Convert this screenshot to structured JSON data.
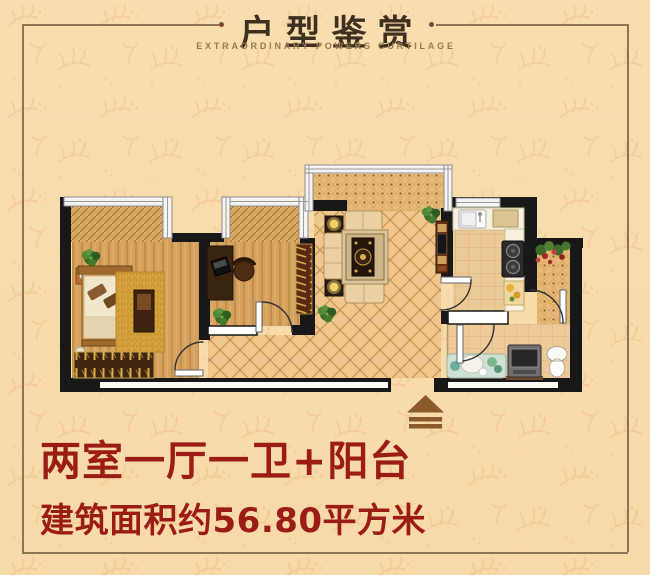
{
  "header": {
    "title": "户型鉴赏",
    "subtitle": "EXTRAORDINARY POWERS CURTILAGE"
  },
  "summary": {
    "layout_label": "两室一厅一卫+阳台",
    "area_label": "建筑面积约56.80平方米"
  },
  "floorplan": {
    "entrance_icon": "entrance-arrow"
  },
  "colors": {
    "background": "#f9dcab",
    "pattern_leaf": "#f0c48d",
    "frame_line": "#8d7454",
    "title_text": "#3e2f20",
    "subtitle_text": "#9a7950",
    "headline_red": "#9b1c15",
    "wall_black": "#181818",
    "window_grey": "#8d8d8d",
    "wood_floor": "#d4a15f",
    "tile_floor": "#efc68d",
    "entrance_arrow": "#8a5a28"
  }
}
